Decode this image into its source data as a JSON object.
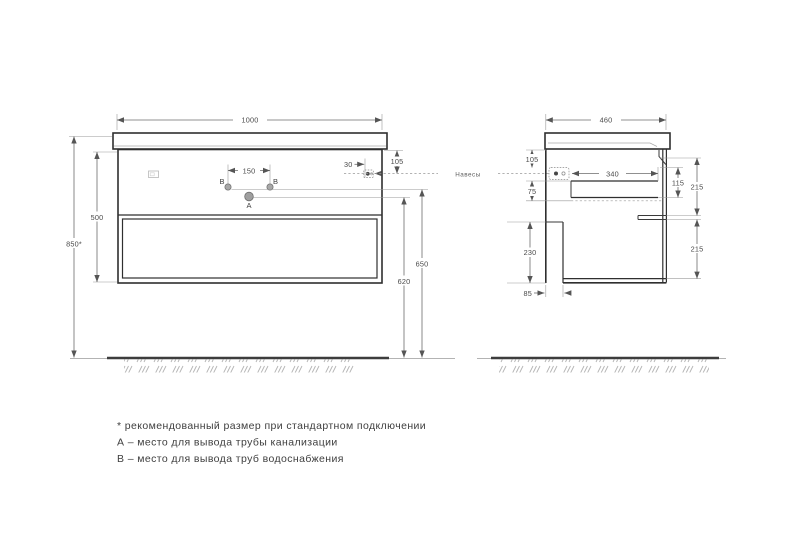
{
  "front_view": {
    "width": "1000",
    "overall_height": "850*",
    "cabinet_height": "500",
    "top_to_hangers": "105",
    "holes_spacing": "150",
    "hanger_side_offset": "30",
    "water_supply_height": "650",
    "drain_height": "620",
    "drain_label": "A",
    "water_label_left": "B",
    "water_label_right": "B"
  },
  "side_view": {
    "depth": "460",
    "top_to_hangers": "105",
    "drawer_height": "75",
    "interior_depth": "340",
    "hanger_to_drawer_bottom": "115",
    "upper_section": "215",
    "lower_drawer_front": "230",
    "lower_section": "215",
    "back_gap": "85"
  },
  "hangers_label": "Навесы",
  "notes": {
    "line1": "* рекомендованный размер при стандартном подключении",
    "line2": "А – место для вывода трубы канализации",
    "line3": "В – место для вывода труб водоснабжения"
  },
  "colors": {
    "outline": "#2f2f2f",
    "dimension_lines": "#6b6b6b",
    "floor": "#3d3d3d",
    "hatch": "#b3b3b3",
    "hole_fill": "#a8a8a8"
  }
}
